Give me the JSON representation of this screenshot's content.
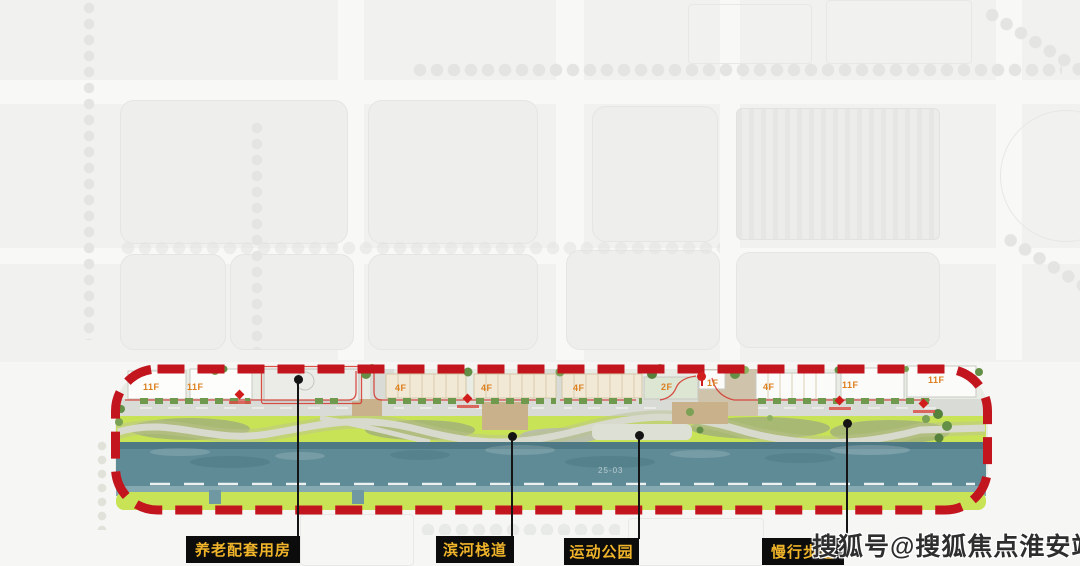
{
  "watermark": {
    "text": "搜狐号@搜狐焦点淮安站"
  },
  "legend": {
    "items": [
      {
        "label": "养老配套用房"
      },
      {
        "label": "滨河栈道"
      },
      {
        "label": "运动公园"
      },
      {
        "label": "慢行步道"
      }
    ]
  },
  "site": {
    "plot_number": "25-03",
    "buildings": [
      {
        "label": "11F"
      },
      {
        "label": "11F"
      },
      {
        "label": "4F"
      },
      {
        "label": "4F"
      },
      {
        "label": "4F"
      },
      {
        "label": "2F"
      },
      {
        "label": "1F"
      },
      {
        "label": "4F"
      },
      {
        "label": "11F"
      },
      {
        "label": "11F"
      }
    ],
    "colors": {
      "boundary_red": "#c2151e",
      "river_teal": "#5f8b96",
      "lawn_green": "#c9e357",
      "legend_gold": "#f0b42a",
      "legend_bg": "#0c0c0c",
      "building_label_orange": "#dc7e1c"
    }
  }
}
